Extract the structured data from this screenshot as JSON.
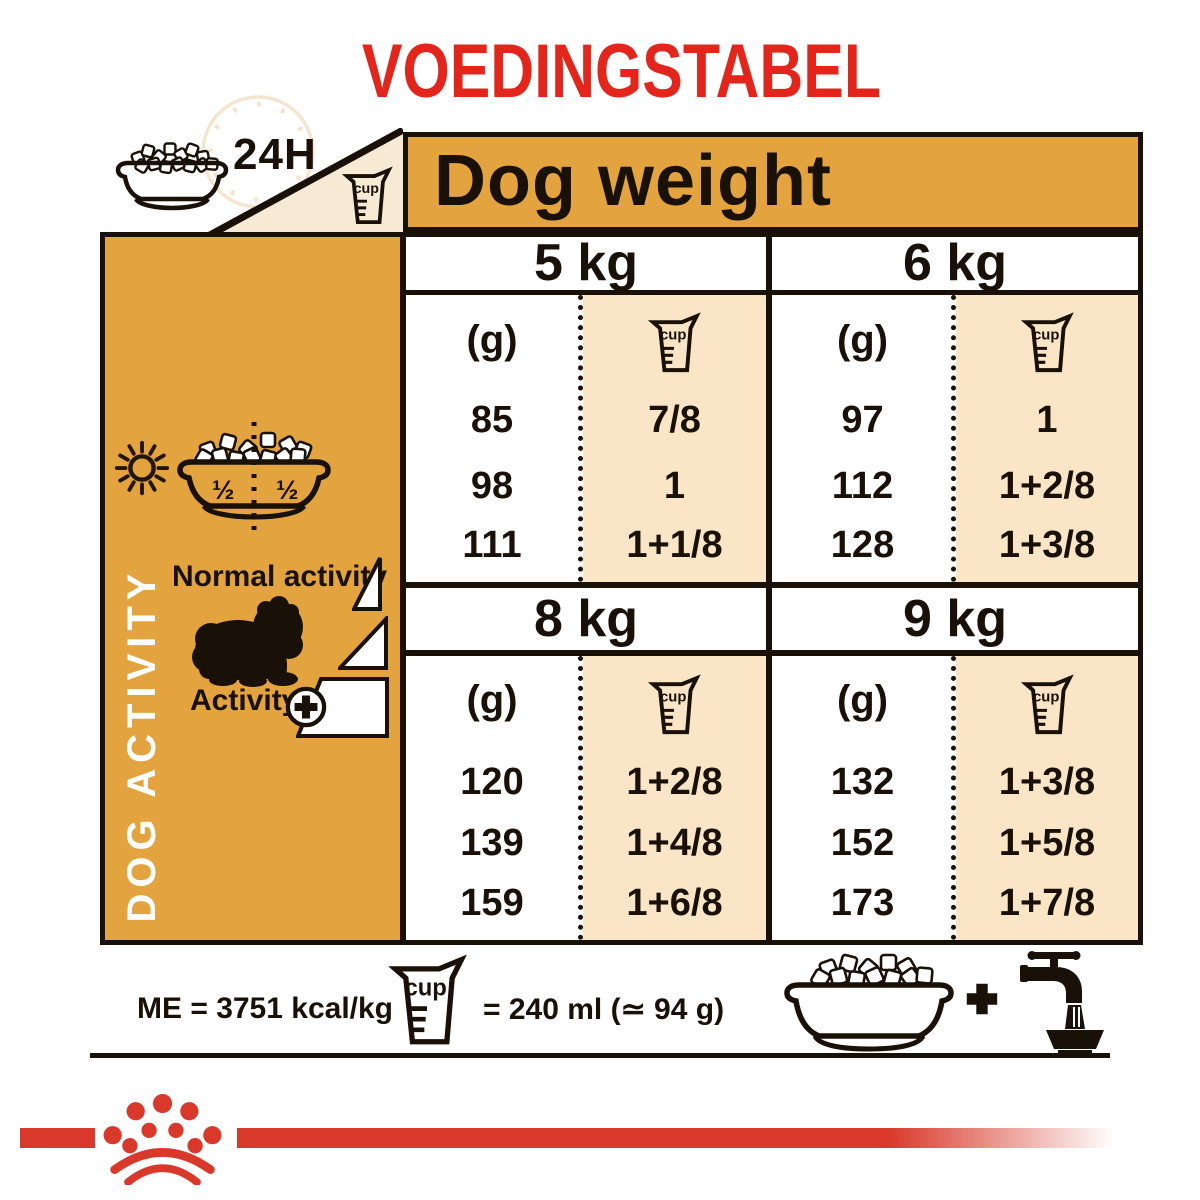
{
  "title": "VOEDINGSTABEL",
  "header": {
    "h24": "24H",
    "dog_weight": "Dog weight",
    "cup": "cup"
  },
  "sidebar": {
    "half_left": "½",
    "half_right": "½",
    "dog_activity": "DOG ACTIVITY",
    "normal_activity": "Normal activity",
    "activity_label": "Activity",
    "plus": "+"
  },
  "table": {
    "gram_unit": "(g)",
    "cup_label": "cup",
    "columns": [
      {
        "weight": "5 kg",
        "grams": [
          "85",
          "98",
          "111"
        ],
        "cups": [
          "7/8",
          "1",
          "1+1/8"
        ]
      },
      {
        "weight": "6 kg",
        "grams": [
          "97",
          "112",
          "128"
        ],
        "cups": [
          "1",
          "1+2/8",
          "1+3/8"
        ]
      },
      {
        "weight": "8 kg",
        "grams": [
          "120",
          "139",
          "159"
        ],
        "cups": [
          "1+2/8",
          "1+4/8",
          "1+6/8"
        ]
      },
      {
        "weight": "9 kg",
        "grams": [
          "132",
          "152",
          "173"
        ],
        "cups": [
          "1+3/8",
          "1+5/8",
          "1+7/8"
        ]
      }
    ]
  },
  "footer": {
    "me": "ME = 3751 kcal/kg",
    "cup_label": "cup",
    "cup_equiv": "= 240 ml (≃ 94 g)",
    "plus": "+"
  },
  "colors": {
    "gold": "#E3A440",
    "cup_column_bg": "#FAE6C6",
    "triangle_bg": "#F6EAD5",
    "title_red": "#E2261C",
    "brand_red": "#D9392B",
    "line_black": "#191007"
  }
}
